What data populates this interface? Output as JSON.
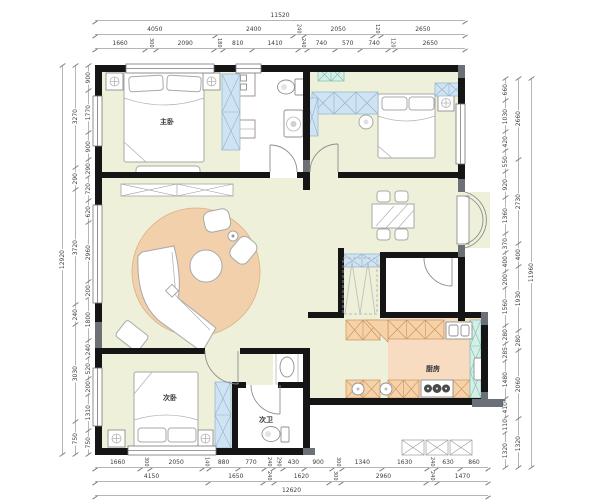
{
  "rooms": {
    "master_bedroom": "主卧",
    "second_bedroom": "次卧",
    "second_bath": "次卫",
    "kitchen": "厨房"
  },
  "dimensions": {
    "top": {
      "total": "11520",
      "row2": [
        "4050",
        "2400",
        "240",
        "2050",
        "120",
        "2650"
      ],
      "row3": [
        "1660",
        "300",
        "2090",
        "180",
        "810",
        "1410",
        "240",
        "740",
        "570",
        "740",
        "120",
        "2650"
      ]
    },
    "bottom": {
      "row1": [
        "1660",
        "300",
        "2050",
        "140",
        "880",
        "770",
        "240",
        "290",
        "430",
        "900",
        "300",
        "1340",
        "1630",
        "240",
        "630",
        "860"
      ],
      "row2": [
        "4150",
        "1650",
        "240",
        "1620",
        "300",
        "2960",
        "240",
        "1470"
      ],
      "total": "12620"
    },
    "left": {
      "total": "12920",
      "mid": [
        "3270",
        "290",
        "3720",
        "240",
        "3030",
        "750"
      ],
      "inner": [
        "900",
        "1770",
        "900",
        "290",
        "720",
        "620",
        "2960",
        "200",
        "1800",
        "240",
        "520",
        "200",
        "1310",
        "750"
      ]
    },
    "right": {
      "total": "11960",
      "mid": [
        "2660",
        "2730",
        "400",
        "1930",
        "280",
        "2060",
        "1320"
      ],
      "inner": [
        "660",
        "1030",
        "420",
        "550",
        "920",
        "1360",
        "370",
        "400",
        "200",
        "1560",
        "280",
        "285",
        "1480",
        "410",
        "110",
        "1320"
      ]
    }
  },
  "colors": {
    "floor": "#eef0d9",
    "rug": "#f1d0ab",
    "kitchen_floor": "#f8dcc2",
    "bath_floor": "#ffffff",
    "wardrobe": "#cfe3f2",
    "balcony": "#d5efe8",
    "counter": "#f6d2a8",
    "wall": "#151515"
  }
}
